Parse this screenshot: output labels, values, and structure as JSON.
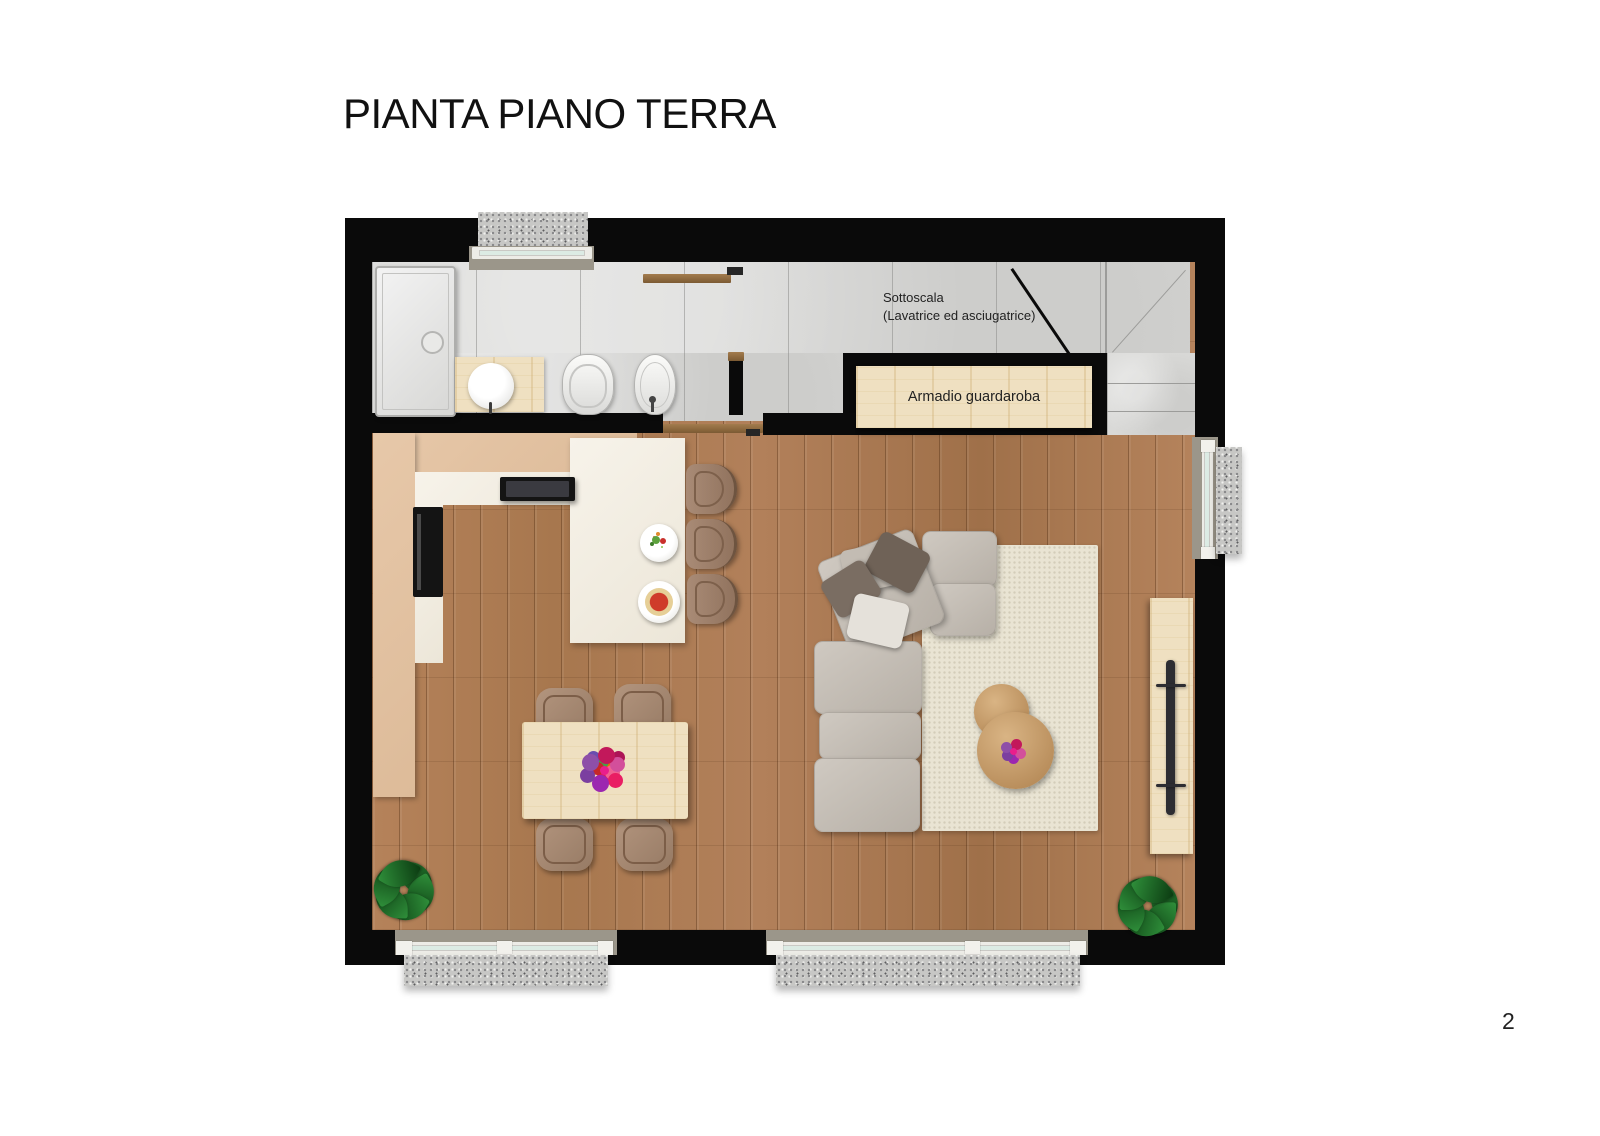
{
  "page": {
    "title": "PIANTA PIANO TERRA",
    "page_number": "2"
  },
  "plan": {
    "annotations": {
      "sottoscala": {
        "line1": "Sottoscala",
        "line2": "(Lavatrice ed asciugatrice)"
      },
      "wardrobe_label": "Armadio guardaroba"
    },
    "colors": {
      "wall": "#0a0a0a",
      "wood_floor": "#ad7a50",
      "tile_floor": "#d9d9d7",
      "kitchen_tan": "#e3c3a3",
      "counter_white": "#f4efe5",
      "light_wood": "#efe0c1",
      "granite_sill": "#c7c7c5",
      "rug": "#e9e4d3",
      "sofa": "#c7c1b8",
      "plant_green": "#1f6b2a",
      "text": "#222222"
    }
  }
}
